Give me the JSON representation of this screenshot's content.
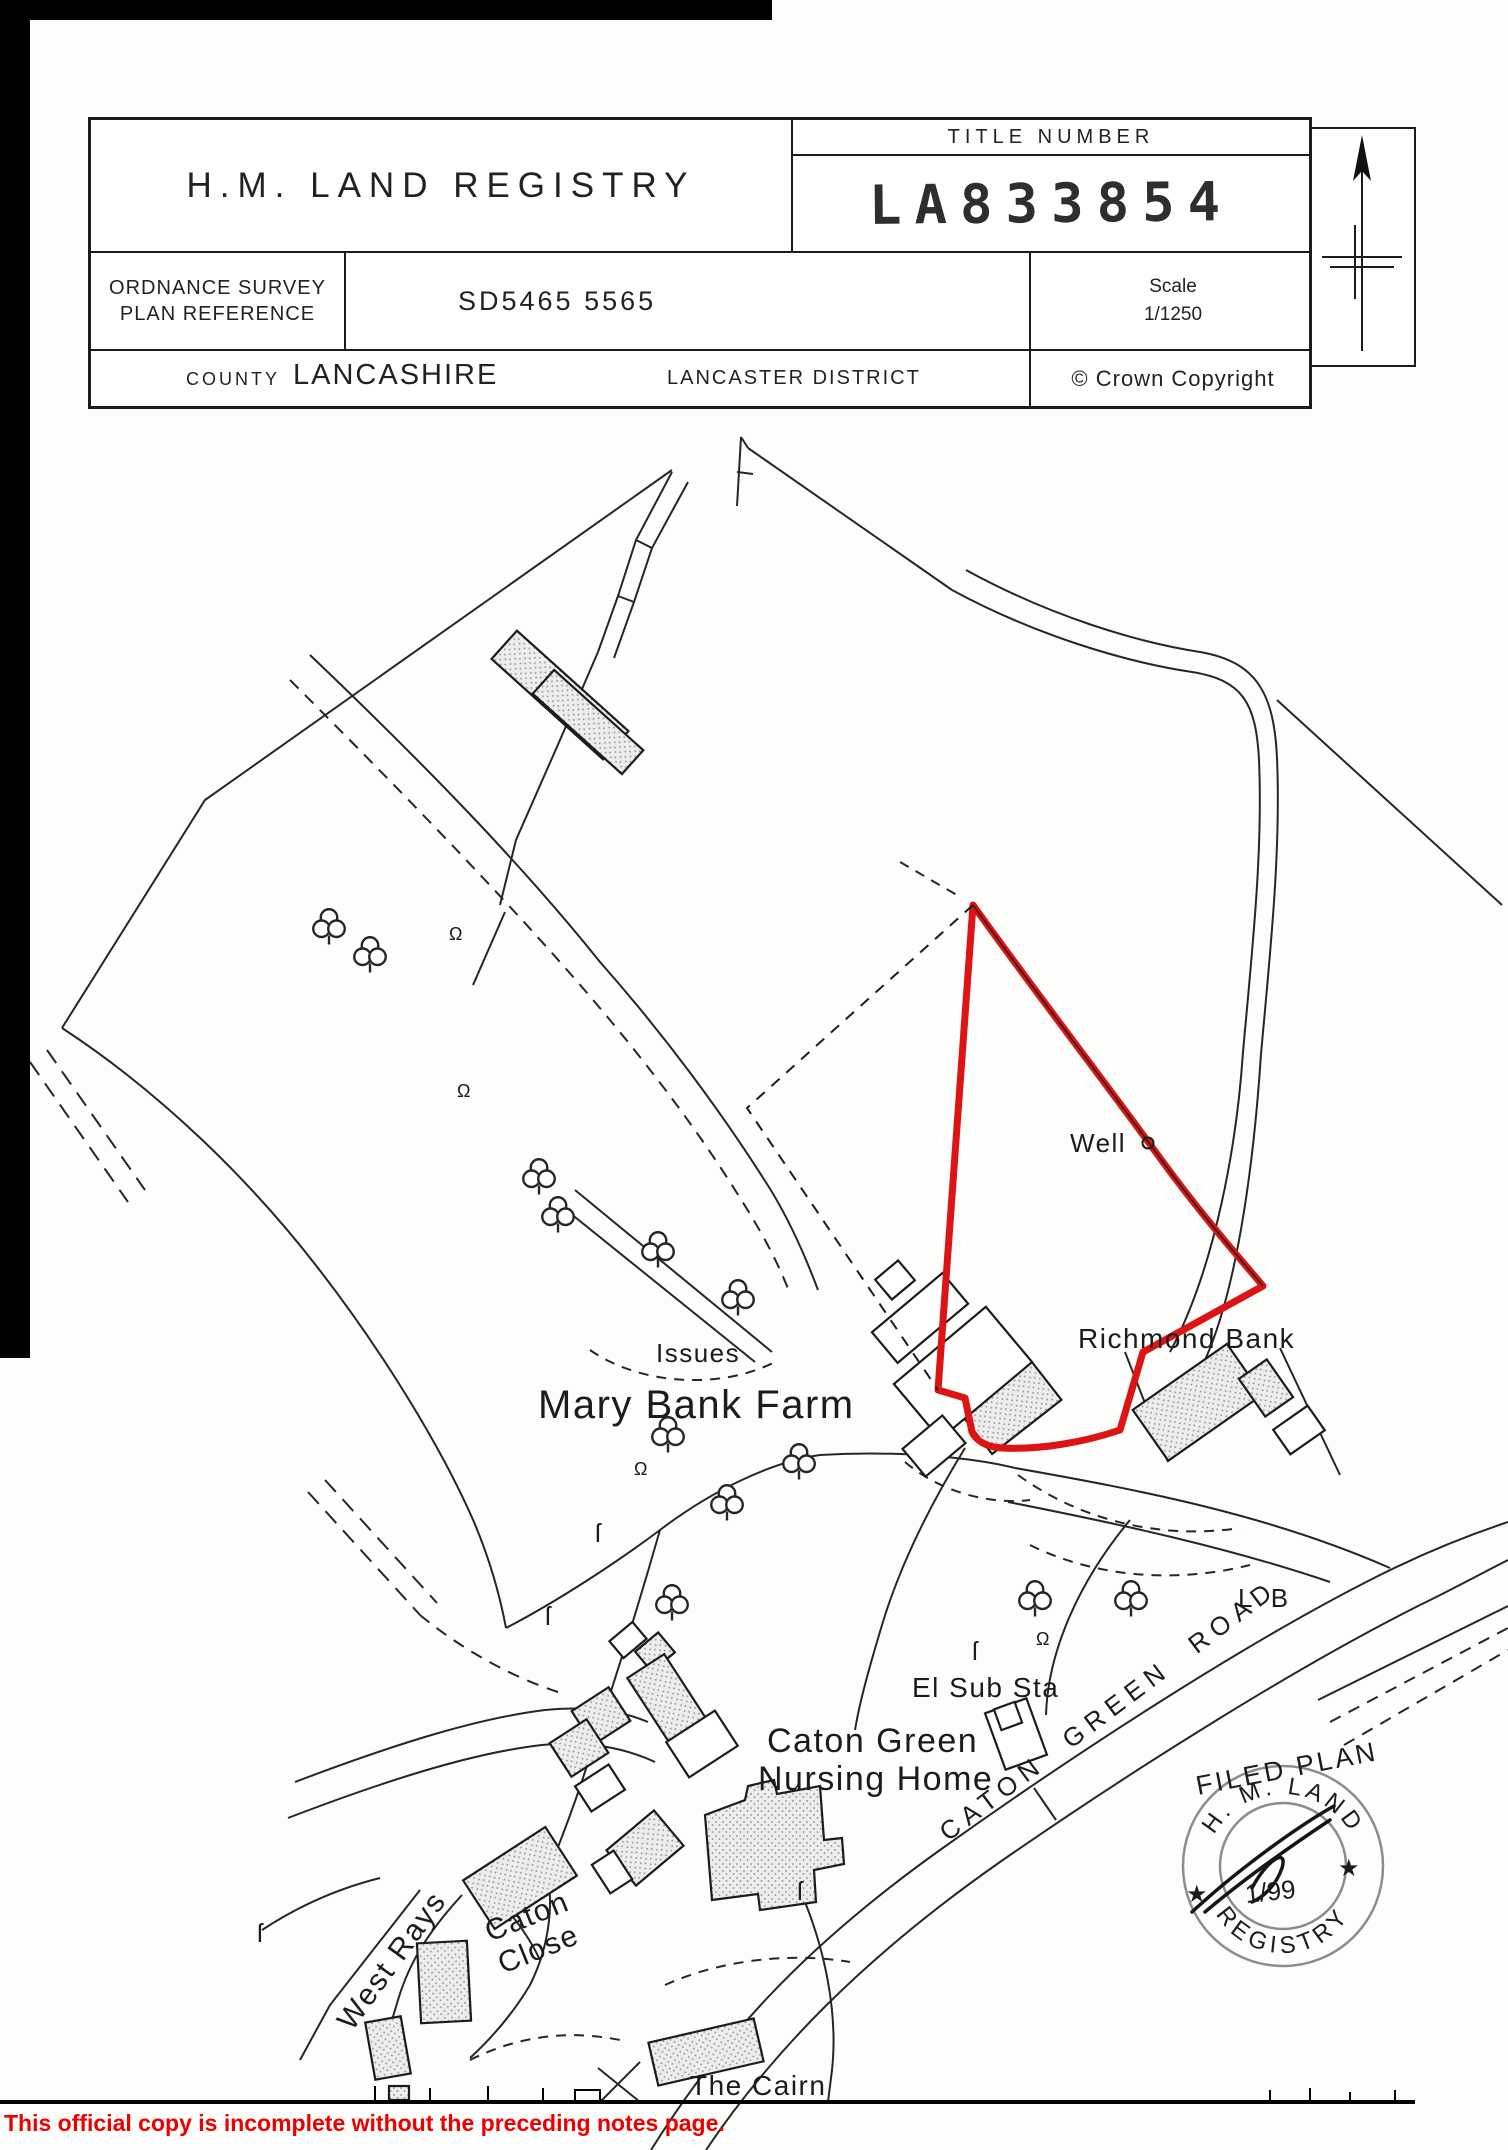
{
  "header": {
    "agency": "H.M. LAND REGISTRY",
    "title_number_label": "TITLE NUMBER",
    "title_number": "LA833854",
    "os_label_line1": "ORDNANCE SURVEY",
    "os_label_line2": "PLAN REFERENCE",
    "os_reference": "SD5465  5565",
    "scale_label": "Scale",
    "scale_value": "1/1250",
    "county_label": "COUNTY",
    "county_value": "LANCASHIRE",
    "district": "LANCASTER DISTRICT",
    "copyright": "© Crown Copyright"
  },
  "map": {
    "boundary_color": "#dd1414",
    "labels": {
      "well": "Well",
      "richmond_bank": "Richmond Bank",
      "issues": "Issues",
      "mary_bank_farm": "Mary Bank Farm",
      "el_sub_sta": "El Sub Sta",
      "caton_green": "Caton Green",
      "nursing_home": "Nursing Home",
      "caton_green_road": "CATON GREEN ROAD",
      "lb": "L B",
      "west_rays": "West Rays",
      "caton": "Caton",
      "close": "Close",
      "the_cairn": "The Cairn"
    }
  },
  "stamp": {
    "filed_plan": "FILED PLAN",
    "arc_top": "H. M. LAND",
    "arc_bottom": "REGISTRY",
    "date": "1/99",
    "star_left": "★",
    "star_right": "★"
  },
  "page": {
    "footer_notice": "This official copy is incomplete without the preceding notes page."
  }
}
